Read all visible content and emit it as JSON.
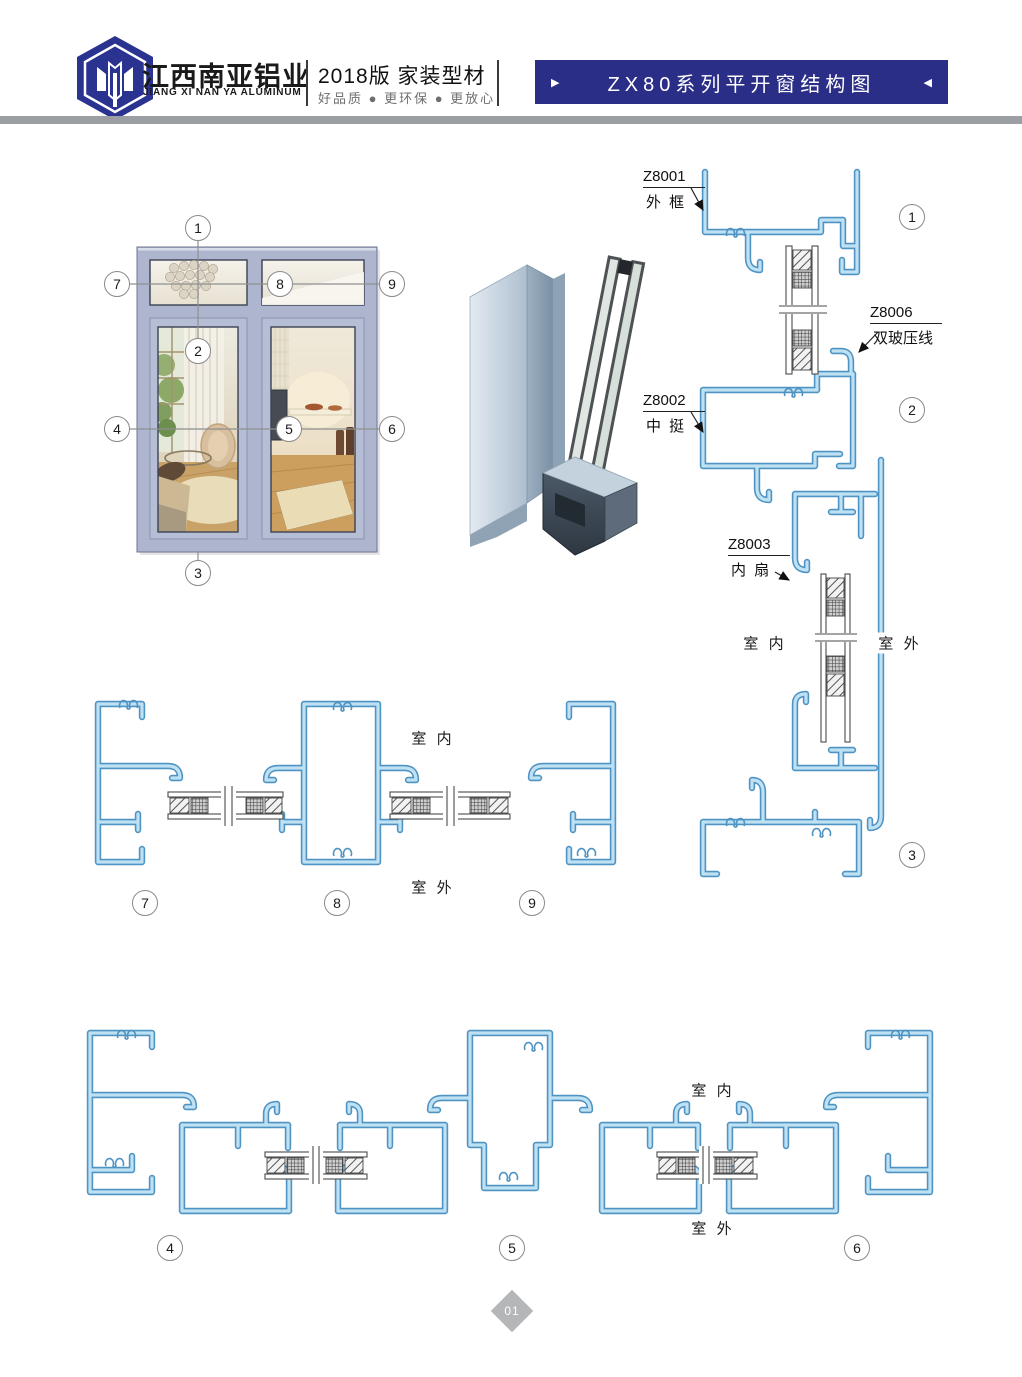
{
  "header": {
    "brand_cn": "江西南亚铝业",
    "brand_en": "JIANG XI NAN YA ALUMINUM",
    "edition": "2018版  家装型材",
    "slogan": "好品质 ● 更环保 ● 更放心",
    "banner_title": "ZX80系列平开窗结构图",
    "banner_arrow_left": "▶",
    "banner_arrow_right": "◀"
  },
  "colors": {
    "brand_navy": "#2b2e87",
    "profile_line_blue": "#4f93c2",
    "profile_fill_blue": "#bfe1f4",
    "window_frame_gray_blue": "#aeb6cf",
    "rule_gray": "#9b9ea3"
  },
  "elevation": {
    "callouts": [
      "1",
      "2",
      "3",
      "4",
      "5",
      "6",
      "7",
      "8",
      "9"
    ]
  },
  "vertical_section": {
    "labels": {
      "z8001": {
        "code": "Z8001",
        "name": "外 框"
      },
      "z8006": {
        "code": "Z8006",
        "name": "双玻压线"
      },
      "z8002": {
        "code": "Z8002",
        "name": "中 挺"
      },
      "z8003": {
        "code": "Z8003",
        "name": "内 扇"
      }
    },
    "indoor": "室 内",
    "outdoor": "室 外",
    "callouts": [
      "1",
      "2",
      "3"
    ]
  },
  "mid_section": {
    "indoor": "室 内",
    "outdoor": "室 外",
    "callouts": [
      "7",
      "8",
      "9"
    ]
  },
  "bottom_section": {
    "indoor": "室 内",
    "outdoor": "室 外",
    "callouts": [
      "4",
      "5",
      "6"
    ]
  },
  "footer": {
    "page_number": "01"
  }
}
